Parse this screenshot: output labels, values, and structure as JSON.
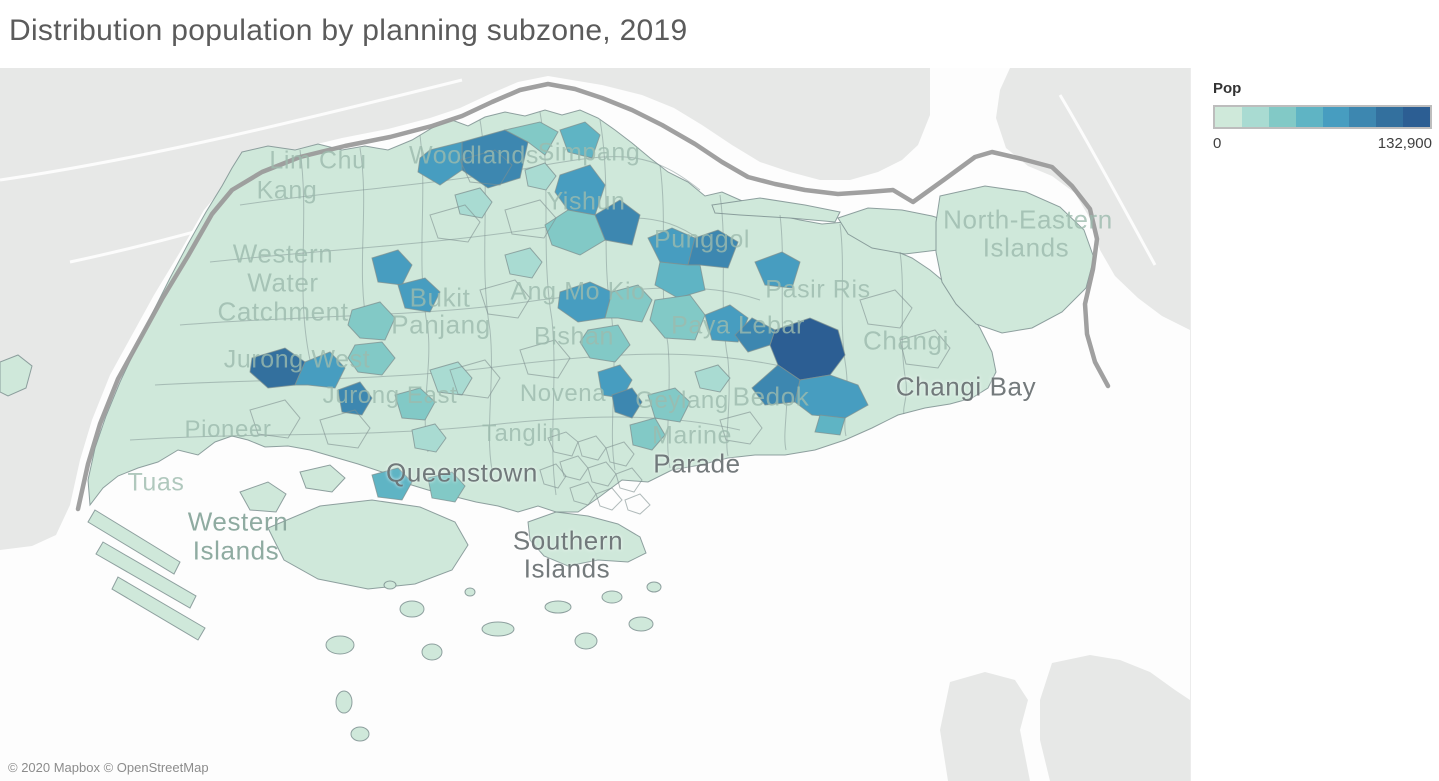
{
  "title": "Distribution population by planning subzone, 2019",
  "attribution": "© 2020 Mapbox © OpenStreetMap",
  "legend": {
    "title": "Pop",
    "min_label": "0",
    "max_label": "132,900",
    "colors": [
      "#cfe9da",
      "#a9dbd2",
      "#82c9c6",
      "#5fb4c4",
      "#479dc0",
      "#3d87b0",
      "#33709e",
      "#2c5e93"
    ]
  },
  "map_colors": {
    "sea": "#fdfdfd",
    "neighbor_land": "#e7e8e7",
    "border_line": "#9b9b9b",
    "base_fill": "#cfe8da",
    "stroke": "#7e9090"
  },
  "map_labels": [
    {
      "text": "Lim Chu",
      "x": 318,
      "y": 93,
      "size": 25,
      "tone": "land"
    },
    {
      "text": "Kang",
      "x": 287,
      "y": 123,
      "size": 25,
      "tone": "land"
    },
    {
      "text": "Woodlands",
      "x": 474,
      "y": 88,
      "size": 25,
      "tone": "land"
    },
    {
      "text": "Simpang",
      "x": 589,
      "y": 85,
      "size": 25,
      "tone": "land"
    },
    {
      "text": "Yishun",
      "x": 586,
      "y": 134,
      "size": 25,
      "tone": "land"
    },
    {
      "text": "Punggol",
      "x": 702,
      "y": 172,
      "size": 25,
      "tone": "land"
    },
    {
      "text": "Western",
      "x": 283,
      "y": 186,
      "size": 26,
      "tone": "land"
    },
    {
      "text": "Water",
      "x": 283,
      "y": 215,
      "size": 26,
      "tone": "land"
    },
    {
      "text": "Catchment",
      "x": 283,
      "y": 244,
      "size": 26,
      "tone": "land"
    },
    {
      "text": "Bukit",
      "x": 440,
      "y": 230,
      "size": 26,
      "tone": "land"
    },
    {
      "text": "Panjang",
      "x": 441,
      "y": 257,
      "size": 26,
      "tone": "land"
    },
    {
      "text": "Ang Mo Kio",
      "x": 578,
      "y": 224,
      "size": 25,
      "tone": "land"
    },
    {
      "text": "Bishan",
      "x": 574,
      "y": 269,
      "size": 25,
      "tone": "land"
    },
    {
      "text": "Novena",
      "x": 563,
      "y": 326,
      "size": 24,
      "tone": "land"
    },
    {
      "text": "Tanglin",
      "x": 522,
      "y": 366,
      "size": 24,
      "tone": "land"
    },
    {
      "text": "Geylang",
      "x": 682,
      "y": 333,
      "size": 24,
      "tone": "land"
    },
    {
      "text": "Bedok",
      "x": 771,
      "y": 329,
      "size": 26,
      "tone": "land"
    },
    {
      "text": "Paya Lebar",
      "x": 738,
      "y": 258,
      "size": 25,
      "tone": "land"
    },
    {
      "text": "Pasir Ris",
      "x": 818,
      "y": 222,
      "size": 25,
      "tone": "land"
    },
    {
      "text": "Changi",
      "x": 906,
      "y": 273,
      "size": 26,
      "tone": "land"
    },
    {
      "text": "Changi Bay",
      "x": 966,
      "y": 319,
      "size": 26,
      "tone": "water"
    },
    {
      "text": "North-Eastern",
      "x": 1028,
      "y": 152,
      "size": 26,
      "tone": "land"
    },
    {
      "text": "Islands",
      "x": 1026,
      "y": 180,
      "size": 26,
      "tone": "land"
    },
    {
      "text": "Jurong West",
      "x": 297,
      "y": 292,
      "size": 25,
      "tone": "land"
    },
    {
      "text": "Jurong East",
      "x": 390,
      "y": 328,
      "size": 24,
      "tone": "land"
    },
    {
      "text": "Pioneer",
      "x": 228,
      "y": 362,
      "size": 24,
      "tone": "land"
    },
    {
      "text": "Tuas",
      "x": 156,
      "y": 415,
      "size": 25,
      "tone": "land"
    },
    {
      "text": "Western",
      "x": 238,
      "y": 454,
      "size": 26,
      "tone": "mid"
    },
    {
      "text": "Islands",
      "x": 236,
      "y": 483,
      "size": 26,
      "tone": "mid"
    },
    {
      "text": "Queenstown",
      "x": 462,
      "y": 405,
      "size": 26,
      "tone": "water"
    },
    {
      "text": "Southern",
      "x": 568,
      "y": 473,
      "size": 26,
      "tone": "water"
    },
    {
      "text": "Islands",
      "x": 567,
      "y": 501,
      "size": 26,
      "tone": "water"
    },
    {
      "text": "Marine",
      "x": 692,
      "y": 368,
      "size": 25,
      "tone": "land"
    },
    {
      "text": "Parade",
      "x": 697,
      "y": 396,
      "size": 26,
      "tone": "water"
    }
  ]
}
